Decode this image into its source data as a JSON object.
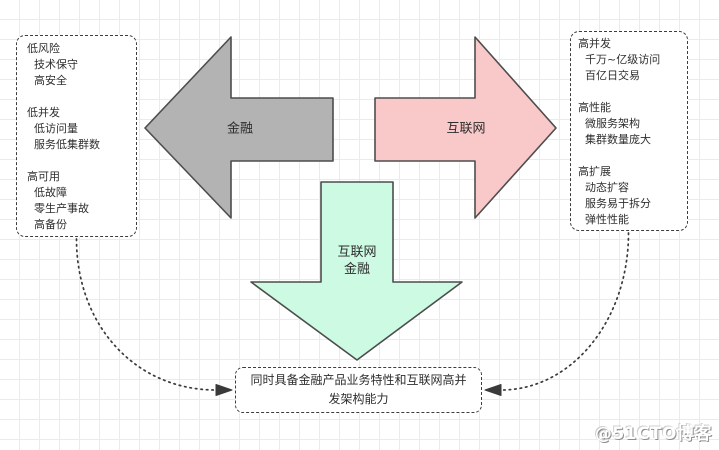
{
  "canvas": {
    "bg": "#ffffff",
    "grid_color": "#ebebeb"
  },
  "panels": {
    "finance_traits": {
      "text": "低风险\n  技术保守\n  高安全\n\n低并发\n  低访问量\n  服务低集群数\n\n高可用\n  低故障\n  零生产事故\n  高备份"
    },
    "internet_traits": {
      "text": "高并发\n  千万~亿级访问\n  百亿日交易\n\n高性能\n  微服务架构\n  集群数量庞大\n\n高扩展\n  动态扩容\n  服务易于拆分\n  弹性性能"
    }
  },
  "arrows": {
    "finance": {
      "label": "金融",
      "fill": "#b3b3b3",
      "stroke": "#4d4d4d"
    },
    "internet": {
      "label": "互联网",
      "fill": "#f9c9c9",
      "stroke": "#4d4d4d"
    },
    "internet_finance": {
      "label": "互联网\n金融",
      "fill": "#ccfae3",
      "stroke": "#4d4d4d"
    }
  },
  "conclusion": {
    "text": "同时具备金融产品业务特性和互联网高并\n发架构能力"
  },
  "watermark": {
    "text": "@51CTO博客"
  }
}
